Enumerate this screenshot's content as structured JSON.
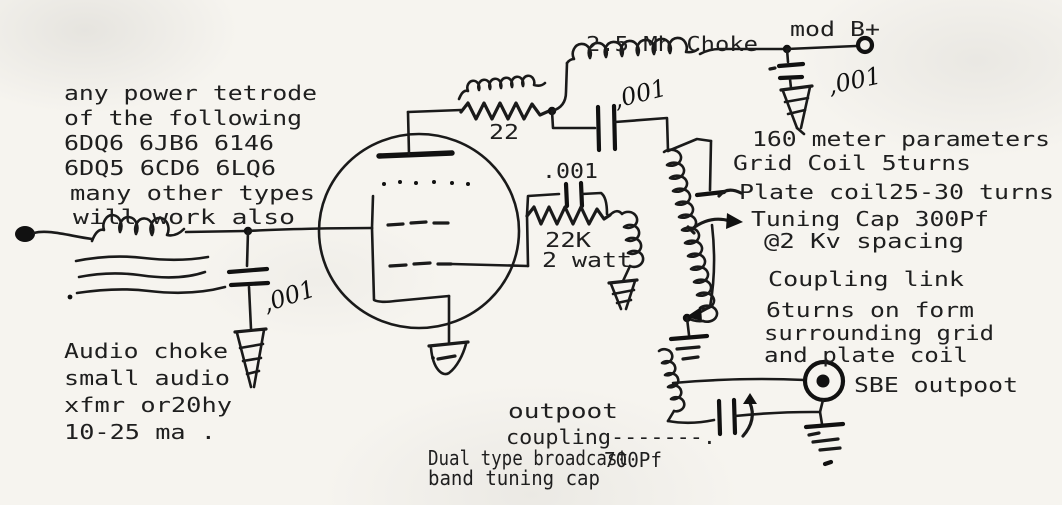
{
  "canvas": {
    "paper": "#f6f4ef",
    "ink": "#1a1a1a"
  },
  "notes": {
    "tube_types": [
      "any power tetrode",
      "of the following",
      "6DQ6 6JB6 6146",
      "6DQ5 6CD6 6LQ6",
      "many other types",
      "will work also"
    ],
    "audio_choke": [
      "Audio choke",
      "small audio",
      "xfmr or20hy",
      "10-25 ma ."
    ],
    "params": [
      "160 meter parameters",
      "Grid Coil 5turns",
      "Plate coil25-30 turns",
      "Tuning Cap 300Pf",
      "@2 Kv spacing"
    ],
    "coupling_link": [
      "Coupling link",
      "6turns on form",
      "surrounding grid",
      "and plate coil"
    ],
    "sbe_output": "SBE outpoot",
    "output_coupling": [
      "outpoot",
      "coupling-------."
    ],
    "tuning_cap": [
      "Dual type broadcast",
      "band tuning cap"
    ],
    "cap_700pf": "700Pf"
  },
  "labels": {
    "plate_choke": "2.5 Mh Choke",
    "mod_b_plus": "mod B+",
    "suppressor_resistor": "22",
    "grid_cap": ".001",
    "grid_resistor": "22K",
    "grid_resistor_watt": "2 watt",
    "bypass_cap_input": ",001",
    "coupling_cap_plate": ",001",
    "bypass_cap_supply": ",001"
  }
}
